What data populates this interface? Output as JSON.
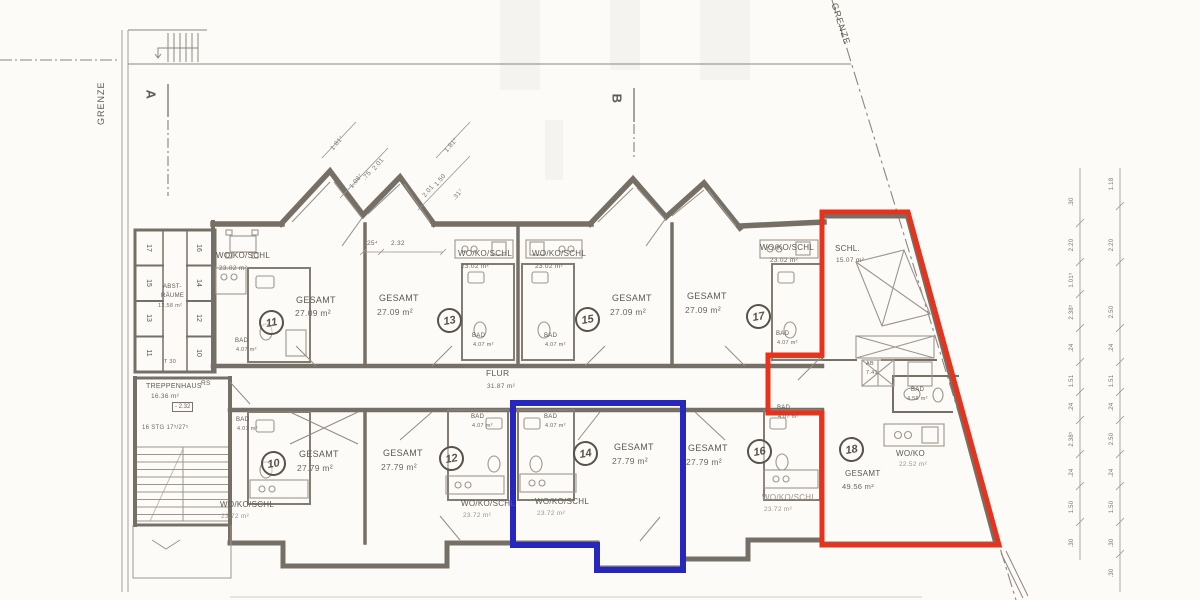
{
  "site": {
    "grenze_left": "GRENZE",
    "grenze_right": "GRENZE",
    "section_a": "A",
    "section_b": "B"
  },
  "corridor": {
    "name": "FLUR",
    "area": "31.87 m²"
  },
  "stairwell": {
    "name": "TREPPENHAUS",
    "area": "16.36 m²",
    "level": "- 2.32",
    "steps": "16 STG  17⁵/27⁵",
    "rs": "RS"
  },
  "storage": {
    "line1": "ABST-",
    "line2": "RÄUME",
    "area": "12.58 m²",
    "door": "T 30",
    "units_left": [
      "17",
      "15",
      "13",
      "11"
    ],
    "units_right": [
      "16",
      "14",
      "12",
      "10"
    ]
  },
  "room_labels": {
    "wohn": "WO/KO/SCHL",
    "gesamt": "GESAMT",
    "bad": "BAD",
    "wo": "WO/KO",
    "schl": "SCHL.",
    "ab": "AB"
  },
  "areas": {
    "top_wohn": "23.02 m²",
    "top_gesamt": "27.09 m²",
    "top_bad": "4.07 m²",
    "bot_wohn": "23.72 m²",
    "bot_gesamt": "27.79 m²",
    "bot_bad": "4.07 m²",
    "a18_schl": "15.07 m²",
    "a18_ab": "7.41",
    "a18_bad": "4.56 m²",
    "a18_wo": "22.52 m²",
    "a18_gesamt": "49.56 m²"
  },
  "units": {
    "u10": "10",
    "u11": "11",
    "u12": "12",
    "u13": "13",
    "u14": "14",
    "u15": "15",
    "u16": "16",
    "u17": "17",
    "u18": "18"
  },
  "dimensions": {
    "gable_left": [
      "1.81⁷",
      "1.08⁷",
      ".75",
      "2.01"
    ],
    "gable_right": [
      "1.81⁷",
      "1.50",
      "2.01",
      ".31⁷"
    ],
    "room13_a": "25⁴",
    "room13_b": "2.32",
    "right_inner": [
      ".30",
      "2.20",
      "1.01⁵",
      "2.38⁵",
      ".24",
      "1.51",
      ".24",
      "2.38⁵",
      ".24",
      "1.50",
      ".30"
    ],
    "right_outer": [
      "1.18",
      "2.20",
      "2.50",
      ".24",
      "1.51",
      ".24",
      "2.50",
      ".24",
      "1.50",
      ".30",
      ".30"
    ]
  },
  "highlight_colors": {
    "red": "#e8321c",
    "blue": "#2727bd"
  }
}
